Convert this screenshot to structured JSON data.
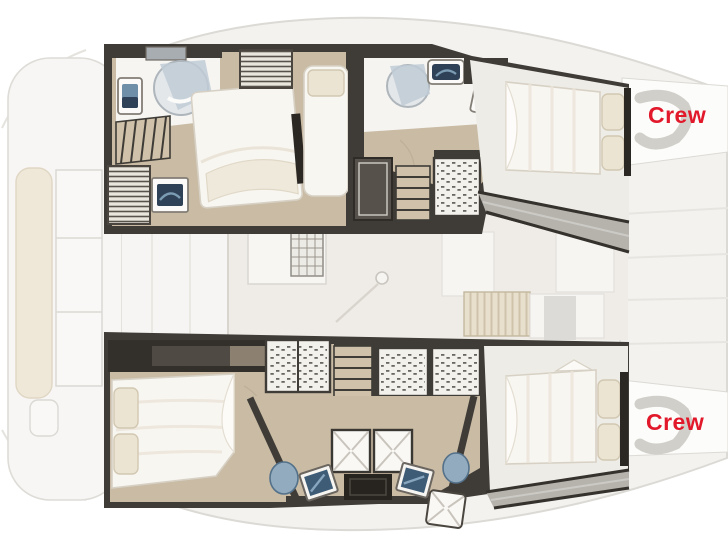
{
  "page": {
    "type": "catamaran-yacht-floorplan"
  },
  "labels": {
    "crew_bow_top": "Crew",
    "crew_bow_bottom": "Crew"
  },
  "colors": {
    "crew_red": "#e2182b",
    "wall_dark": "#3f3c37",
    "wall_darker": "#2b2824",
    "floor_tan": "#c9bba4",
    "salon_floor": "#efece7",
    "deck_light": "#f3f2ef",
    "deck_line": "#dcdad5",
    "deck_white": "#fcfcfa",
    "side_deck_gray": "#b6b3ad",
    "bed_white": "#f8f6f1",
    "bed_line": "#d7d1c5",
    "cushion_cream": "#ebe4d3",
    "cushion_line": "#d2c8b2",
    "fixture_white": "#fbfaf8",
    "fixture_navy": "#2e4156",
    "fixture_blue": "#6f8fa8",
    "fixture_blue_light": "#93abbe",
    "shower_gray": "#e3e7ea",
    "shower_rim": "#aeb6bc",
    "glass_blue": "#bfcbd6",
    "appliance_face": "#f3f1eb",
    "stair_tread": "#d0c2aa",
    "table_dark": "#27241f"
  }
}
